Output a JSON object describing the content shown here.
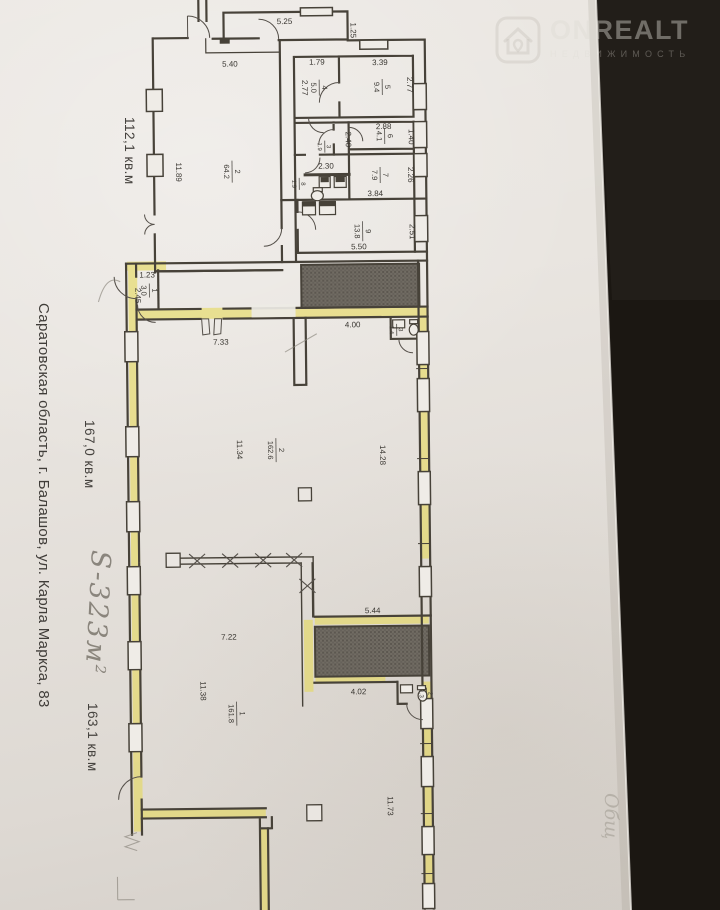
{
  "watermark": {
    "brand": "ONREALT",
    "subtitle": "НЕДВИЖИМОСТЬ"
  },
  "margins": {
    "area_upper": "112,1 кв.м",
    "area_middle": "167,0 кв.м",
    "area_lower": "163,1 кв.м",
    "address": "Саратовская область, г. Балашов, ул. Карла Маркса, 83",
    "handwritten_area": "S-323м",
    "handwritten_sup": "2",
    "faint_note": "Общ"
  },
  "plan": {
    "upper": {
      "rooms": {
        "r2": {
          "num": "2",
          "area": "64.2"
        },
        "r3": {
          "num": "3",
          "area": "1.9"
        },
        "r4": {
          "num": "4",
          "area": "5.0"
        },
        "r5": {
          "num": "5",
          "area": "9.4"
        },
        "r6": {
          "num": "6",
          "area": "4.1"
        },
        "r7": {
          "num": "7",
          "area": "7.9"
        },
        "r8": {
          "num": "8",
          "area": "1.9"
        },
        "r9": {
          "num": "9",
          "area": "13.8"
        }
      },
      "dims": {
        "d525": "5.25",
        "d125": "1.25",
        "d540": "5.40",
        "d179": "1.79",
        "d339": "3.39",
        "d277a": "2.77",
        "d277b": "2.77",
        "d288": "2.88",
        "d140": "1.40",
        "d240": "2.40",
        "d230": "2.30",
        "d226": "2.26",
        "d384": "3.84",
        "d251": "2.51",
        "d550": "5.50",
        "d1189": "11.89"
      }
    },
    "middle": {
      "rooms": {
        "r1": {
          "num": "1",
          "area": "3.0"
        },
        "r2": {
          "num": "2",
          "area": "162.6"
        },
        "r3": {
          "num": "3",
          "area": "1.4"
        }
      },
      "dims": {
        "d123": "1.23",
        "d245": "2.45",
        "d733": "7.33",
        "d400": "4.00",
        "d1134": "11.34",
        "d1428": "14.28"
      }
    },
    "lower": {
      "rooms": {
        "r1": {
          "num": "1",
          "area": "161.8"
        },
        "r2": {
          "num": "2",
          "area": "1.3"
        }
      },
      "dims": {
        "d544": "5.44",
        "d722": "7.22",
        "d1138": "11.38",
        "d402": "4.02",
        "d1173": "11.73"
      }
    }
  }
}
